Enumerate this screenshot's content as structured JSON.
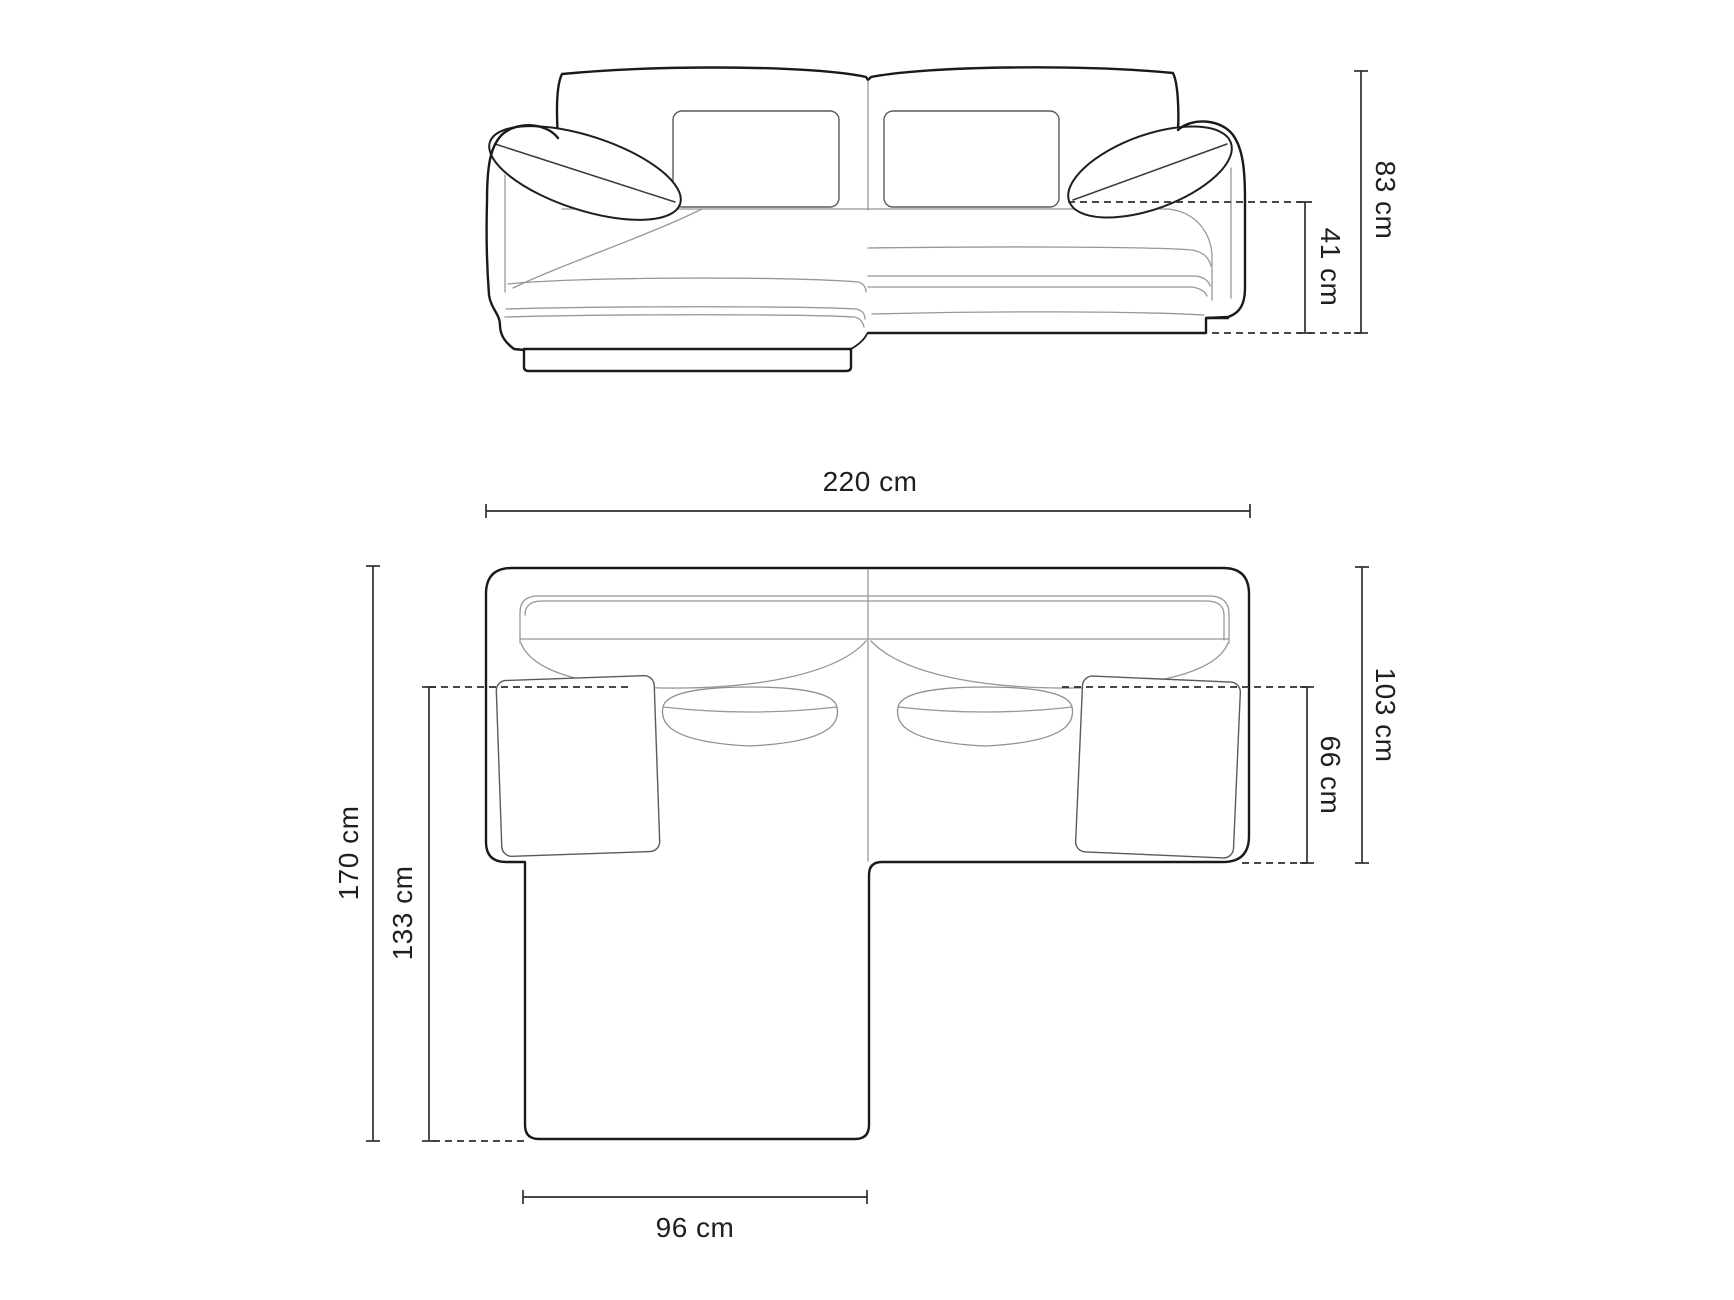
{
  "diagram": {
    "subject": "corner-sofa-with-chaise",
    "views": [
      "front-elevation",
      "top-plan"
    ]
  },
  "dimensions": {
    "front_view": {
      "total_height": "83 cm",
      "seat_height": "41 cm"
    },
    "top_view": {
      "total_width": "220 cm",
      "total_depth": "170 cm",
      "chaise_length": "133 cm",
      "chaise_width": "96 cm",
      "body_depth": "103 cm",
      "seat_depth": "66 cm"
    }
  },
  "colors": {
    "background": "#ffffff",
    "outline": "#1a1a1a",
    "detail_line": "#979797",
    "dimension_line": "#2e2e2e",
    "label_text": "#1f1f1f"
  }
}
